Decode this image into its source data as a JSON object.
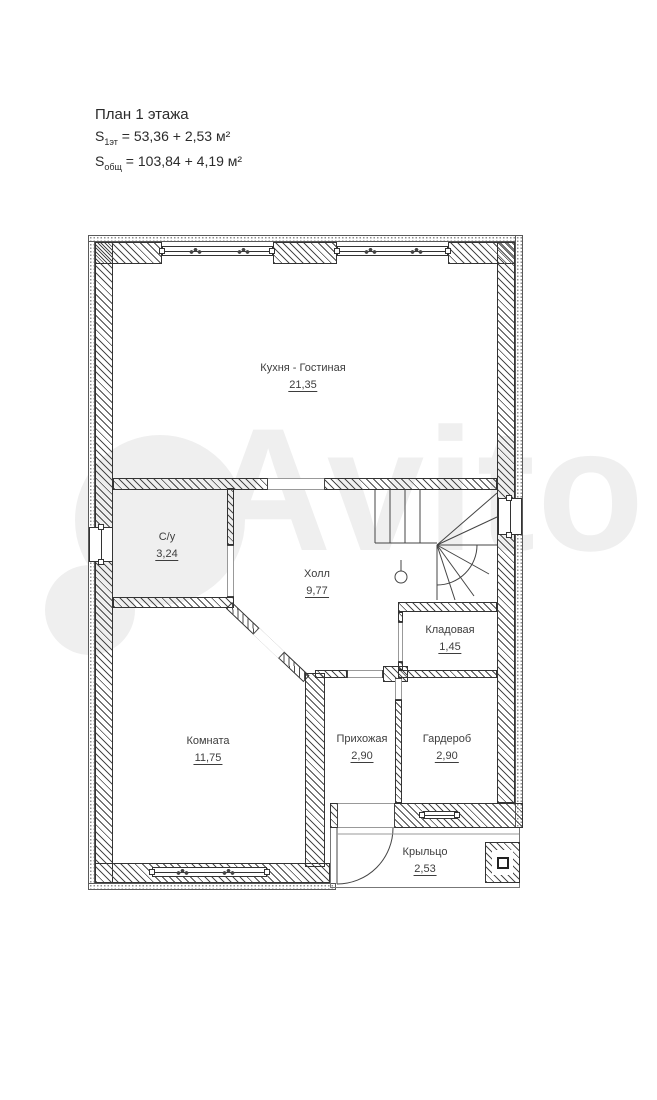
{
  "title": {
    "heading": "План 1 этажа",
    "s1_prefix": "S",
    "s1_sub": "1эт",
    "s1_rest": " = 53,36 + 2,53 м²",
    "s2_prefix": "S",
    "s2_sub": "общ",
    "s2_rest": " = 103,84 + 4,19 м²"
  },
  "watermark": "Avito",
  "rooms": [
    {
      "name": "Кухня - Гостиная",
      "area": "21,35"
    },
    {
      "name": "С/у",
      "area": "3,24"
    },
    {
      "name": "Холл",
      "area": "9,77"
    },
    {
      "name": "Кладовая",
      "area": "1,45"
    },
    {
      "name": "Комната",
      "area": "11,75"
    },
    {
      "name": "Прихожая",
      "area": "2,90"
    },
    {
      "name": "Гардероб",
      "area": "2,90"
    },
    {
      "name": "Крыльцо",
      "area": "2,53"
    }
  ]
}
